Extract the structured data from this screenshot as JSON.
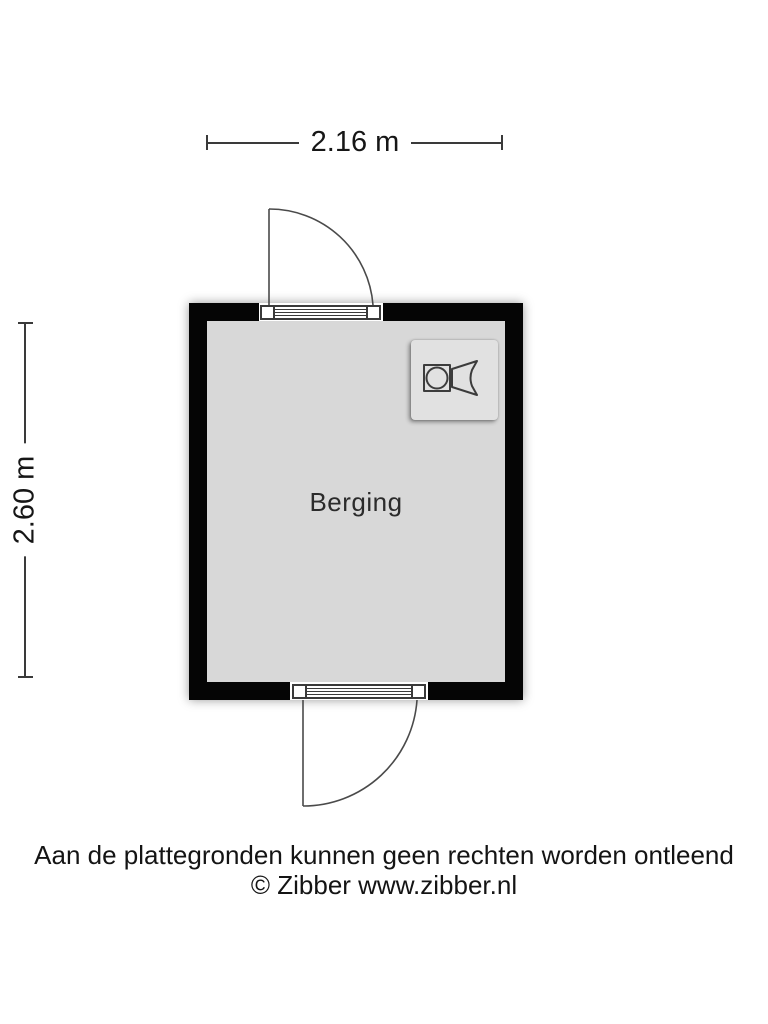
{
  "plan": {
    "type": "floorplan",
    "room": {
      "label": "Berging"
    },
    "dimensions": {
      "width_label": "2.16 m",
      "height_label": "2.60 m"
    },
    "doors": [
      {
        "wall": "top",
        "hinge": "left",
        "swing": "outward"
      },
      {
        "wall": "bottom",
        "hinge": "left",
        "swing": "outward"
      }
    ],
    "fixtures": [
      {
        "type": "washing-machine",
        "location": "top-right"
      }
    ]
  },
  "footer": {
    "disclaimer": "Aan de plattegronden kunnen geen rechten worden ontleend",
    "credit": "© Zibber www.zibber.nl"
  },
  "colors": {
    "wall": "#050505",
    "floor": "#d8d8d8",
    "dimension_line": "#3a3a3a",
    "door_line": "#4a4a4a",
    "appliance_panel": "#e1e1e1",
    "text": "#161616"
  }
}
